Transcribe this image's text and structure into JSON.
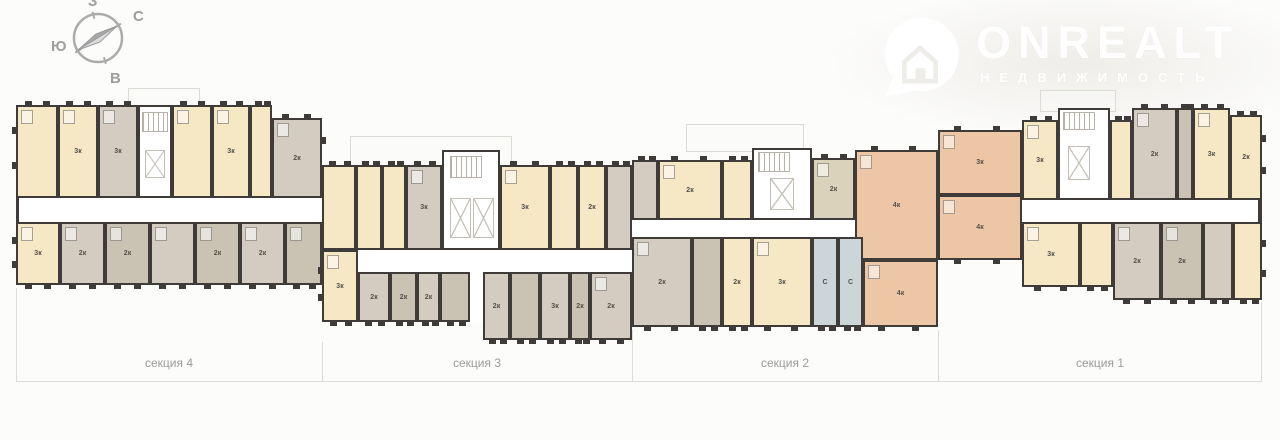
{
  "canvas": {
    "width": 1280,
    "height": 440,
    "background": "#fcfcfb"
  },
  "compass": {
    "west": "З",
    "north": "С",
    "south": "Ю",
    "east": "В"
  },
  "logo": {
    "title": "ONREALT",
    "subtitle": "НЕДВИЖИМОСТЬ",
    "color": "#ffffff"
  },
  "footer": {
    "labels": [
      "секция 4",
      "секция 3",
      "секция 2",
      "секция 1"
    ],
    "centers": [
      169,
      477,
      785,
      1100
    ],
    "label_y": 356,
    "baseline": {
      "x": 16,
      "y": 381,
      "w": 1246
    },
    "verticals": [
      [
        16,
        288
      ],
      [
        322,
        342
      ],
      [
        632,
        330
      ],
      [
        938,
        330
      ],
      [
        1261,
        302
      ]
    ]
  },
  "plan": {
    "wall_color": "#3e3b38",
    "palette": {
      "cream": "#f6e7c5",
      "gray": "#d4ccc0",
      "gray2": "#cac2b3",
      "tan": "#dbd2bc",
      "peach": "#edc7a5",
      "blue": "#ccd6d8"
    },
    "unit_labels_legend": [
      "2к",
      "3к",
      "4к",
      "С"
    ],
    "ghosts": [
      [
        128,
        88,
        70,
        18
      ],
      [
        350,
        136,
        160,
        30
      ],
      [
        686,
        124,
        116,
        26
      ],
      [
        1040,
        90,
        74,
        20
      ]
    ],
    "corridors": [
      [
        16,
        198,
        306,
        24
      ],
      [
        322,
        250,
        310,
        22
      ],
      [
        470,
        272,
        13,
        50
      ],
      [
        632,
        220,
        223,
        17
      ],
      [
        1022,
        200,
        240,
        22
      ]
    ],
    "units": [
      [
        16,
        105,
        42,
        93,
        "cream",
        "",
        "tl"
      ],
      [
        58,
        105,
        40,
        93,
        "cream",
        "3к",
        "t"
      ],
      [
        98,
        105,
        40,
        93,
        "gray",
        "3к",
        "t"
      ],
      [
        172,
        105,
        40,
        93,
        "cream",
        "",
        "t"
      ],
      [
        212,
        105,
        38,
        93,
        "cream",
        "3к",
        "t"
      ],
      [
        250,
        105,
        22,
        93,
        "cream",
        "",
        "t"
      ],
      [
        272,
        118,
        50,
        80,
        "gray",
        "2к",
        "tr"
      ],
      [
        16,
        222,
        44,
        63,
        "cream",
        "3к",
        "bl"
      ],
      [
        60,
        222,
        45,
        63,
        "gray",
        "2к",
        "b"
      ],
      [
        105,
        222,
        45,
        63,
        "gray2",
        "2к",
        "b"
      ],
      [
        150,
        222,
        45,
        63,
        "gray",
        "",
        "b"
      ],
      [
        195,
        222,
        45,
        63,
        "gray2",
        "2к",
        "b"
      ],
      [
        240,
        222,
        45,
        63,
        "gray",
        "2к",
        "b"
      ],
      [
        285,
        222,
        37,
        63,
        "gray2",
        "",
        "b"
      ],
      [
        322,
        165,
        34,
        85,
        "cream",
        "",
        "t"
      ],
      [
        356,
        165,
        26,
        85,
        "cream",
        "",
        "t"
      ],
      [
        382,
        165,
        24,
        85,
        "cream",
        "",
        "t"
      ],
      [
        406,
        165,
        36,
        85,
        "gray",
        "3к",
        "t"
      ],
      [
        500,
        165,
        50,
        85,
        "cream",
        "3к",
        "t"
      ],
      [
        550,
        165,
        28,
        85,
        "cream",
        "",
        "t"
      ],
      [
        578,
        165,
        28,
        85,
        "cream",
        "2к",
        "t"
      ],
      [
        606,
        165,
        26,
        85,
        "gray",
        "",
        "t"
      ],
      [
        322,
        250,
        36,
        72,
        "cream",
        "3к",
        "bl"
      ],
      [
        358,
        272,
        32,
        50,
        "gray",
        "2к",
        "b"
      ],
      [
        390,
        272,
        27,
        50,
        "gray2",
        "2к",
        "b"
      ],
      [
        417,
        272,
        23,
        50,
        "gray",
        "2к",
        "b"
      ],
      [
        440,
        272,
        30,
        50,
        "gray2",
        "",
        "b"
      ],
      [
        483,
        272,
        27,
        68,
        "gray",
        "2к",
        "b"
      ],
      [
        510,
        272,
        30,
        68,
        "gray2",
        "",
        "b"
      ],
      [
        540,
        272,
        30,
        68,
        "gray",
        "3к",
        "b"
      ],
      [
        570,
        272,
        20,
        68,
        "gray2",
        "2к",
        "b"
      ],
      [
        590,
        272,
        42,
        68,
        "gray",
        "2к",
        "b"
      ],
      [
        632,
        160,
        26,
        60,
        "gray",
        "",
        "t"
      ],
      [
        658,
        160,
        64,
        60,
        "cream",
        "2к",
        "t"
      ],
      [
        722,
        160,
        30,
        60,
        "cream",
        "",
        "t"
      ],
      [
        812,
        158,
        43,
        62,
        "tan",
        "2к",
        "t"
      ],
      [
        855,
        150,
        83,
        110,
        "peach",
        "4к",
        "t"
      ],
      [
        632,
        237,
        60,
        90,
        "gray",
        "2к",
        "b"
      ],
      [
        692,
        237,
        30,
        90,
        "gray2",
        "",
        "b"
      ],
      [
        722,
        237,
        30,
        90,
        "cream",
        "2к",
        "b"
      ],
      [
        752,
        237,
        60,
        90,
        "cream",
        "3к",
        "b"
      ],
      [
        812,
        237,
        26,
        90,
        "blue",
        "С",
        "b"
      ],
      [
        838,
        237,
        25,
        90,
        "blue",
        "С",
        "b"
      ],
      [
        863,
        260,
        75,
        67,
        "peach",
        "4к",
        "b"
      ],
      [
        938,
        130,
        84,
        65,
        "peach",
        "3к",
        "t"
      ],
      [
        938,
        195,
        84,
        65,
        "peach",
        "4к",
        "b"
      ],
      [
        1022,
        120,
        36,
        80,
        "cream",
        "3к",
        "t"
      ],
      [
        1110,
        120,
        22,
        80,
        "cream",
        "",
        "t"
      ],
      [
        1132,
        108,
        45,
        92,
        "gray",
        "2к",
        "t"
      ],
      [
        1177,
        108,
        16,
        92,
        "gray2",
        "",
        "t"
      ],
      [
        1193,
        108,
        37,
        92,
        "cream",
        "3к",
        "t"
      ],
      [
        1230,
        115,
        32,
        85,
        "cream",
        "2к",
        "tr"
      ],
      [
        1022,
        222,
        58,
        65,
        "cream",
        "3к",
        "b"
      ],
      [
        1080,
        222,
        33,
        65,
        "cream",
        "",
        "b"
      ],
      [
        1113,
        222,
        48,
        78,
        "gray",
        "2к",
        "b"
      ],
      [
        1161,
        222,
        42,
        78,
        "gray2",
        "2к",
        "b"
      ],
      [
        1203,
        222,
        30,
        78,
        "gray",
        "",
        "b"
      ],
      [
        1233,
        222,
        29,
        78,
        "cream",
        "",
        "br"
      ]
    ],
    "cores": [
      [
        138,
        105,
        34,
        93
      ],
      [
        442,
        150,
        58,
        100
      ],
      [
        752,
        148,
        60,
        72
      ],
      [
        1058,
        108,
        52,
        92
      ]
    ],
    "hatches": [
      [
        142,
        112,
        26,
        20
      ],
      [
        450,
        156,
        32,
        22
      ],
      [
        758,
        152,
        32,
        20
      ],
      [
        1063,
        112,
        32,
        18
      ]
    ],
    "lifts": [
      [
        145,
        150,
        20,
        28
      ],
      [
        450,
        198,
        21,
        40
      ],
      [
        473,
        198,
        21,
        40
      ],
      [
        770,
        178,
        24,
        32
      ],
      [
        1068,
        146,
        22,
        34
      ]
    ],
    "walls": [
      [
        16,
        196,
        3,
        28
      ],
      [
        1258,
        198,
        4,
        26
      ]
    ]
  }
}
